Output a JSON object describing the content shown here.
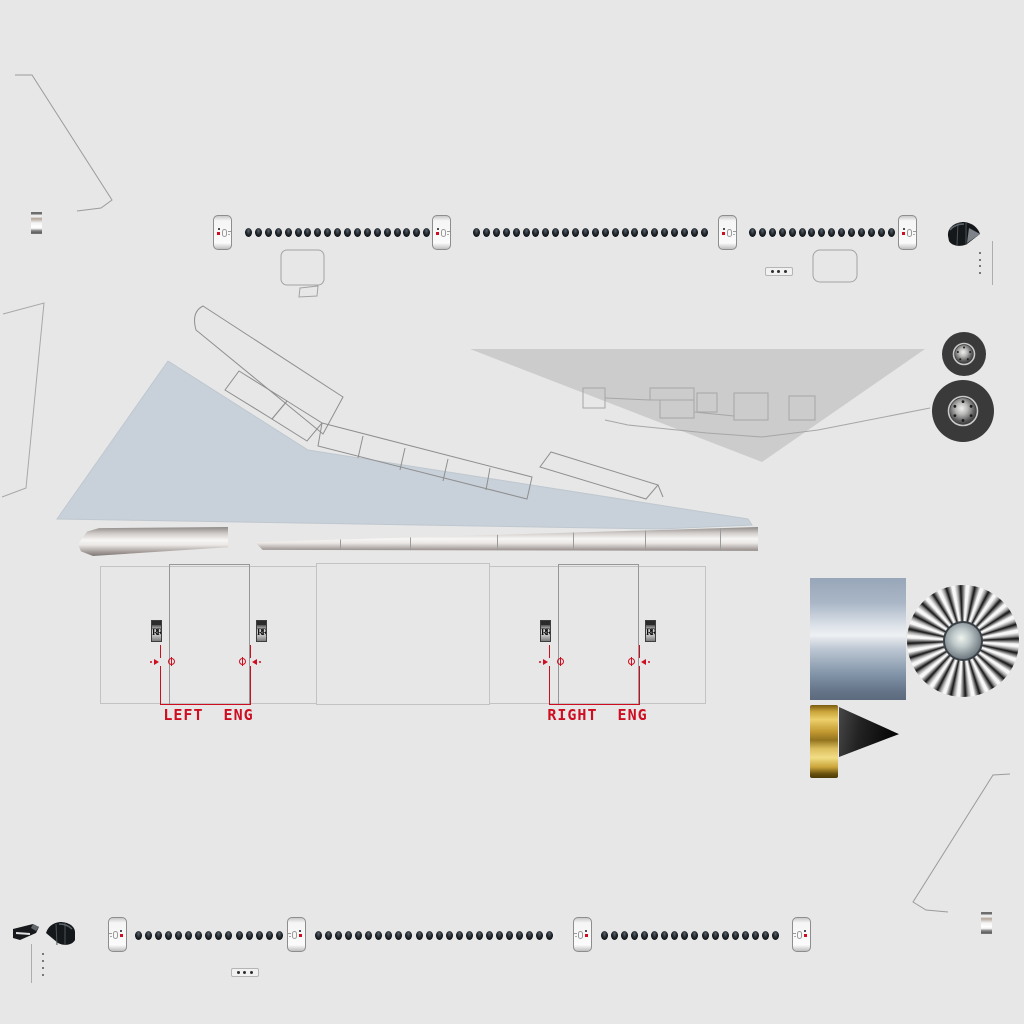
{
  "sheet": {
    "name": "aircraft livery texture sheet",
    "background": "#e7e7e7"
  },
  "colors": {
    "accent_red": "#ce0e20",
    "wing_blue": "#c8d0d9",
    "panel_gray": "#cccccc",
    "outline_gray": "#9b9b9b",
    "metal_highlight": "#f6f5f4",
    "nacelle_blue": "#93a3b6",
    "gold": "#d4af4e",
    "window_dark": "#0e1114"
  },
  "engines": {
    "badge_label": "RR",
    "left": {
      "label": "LEFT  ENG"
    },
    "right": {
      "label": "RIGHT  ENG"
    }
  },
  "fuselage_top": {
    "door_y": 215,
    "doors_x": [
      213,
      432,
      718,
      898
    ],
    "window_y": 228,
    "window_spacing": 9.9,
    "window_rows": [
      {
        "x": 245,
        "count": 19
      },
      {
        "x": 473,
        "count": 24
      },
      {
        "x": 749,
        "count": 15
      }
    ],
    "placard": {
      "x": 765,
      "y": 267,
      "dots": 3
    },
    "dot_column": {
      "x": 979,
      "y": 252,
      "count": 4,
      "spacing": 6.5
    },
    "tick_line": {
      "x": 992,
      "y": 241,
      "h": 44
    }
  },
  "fuselage_bottom": {
    "door_y": 917,
    "doors_x": [
      108,
      287,
      573,
      792
    ],
    "window_y": 931,
    "window_spacing": 10.05,
    "window_rows": [
      {
        "x": 135,
        "count": 15
      },
      {
        "x": 315,
        "count": 24
      },
      {
        "x": 601,
        "count": 18
      }
    ],
    "placard": {
      "x": 231,
      "y": 968,
      "dots": 3
    },
    "dot_column": {
      "x": 42,
      "y": 953,
      "count": 4,
      "spacing": 7
    },
    "tick_line": {
      "x": 31,
      "y": 944,
      "h": 39
    }
  },
  "landing_gear": {
    "wheels": [
      {
        "cx": 964,
        "cy": 354,
        "r": 22,
        "hub_r": 9,
        "bolts": 5
      },
      {
        "cx": 963,
        "cy": 411,
        "r": 31,
        "hub_r": 13,
        "bolts": 6
      }
    ]
  },
  "fan": {
    "cx": 963,
    "cy": 641,
    "r": 56,
    "blades": 24
  }
}
